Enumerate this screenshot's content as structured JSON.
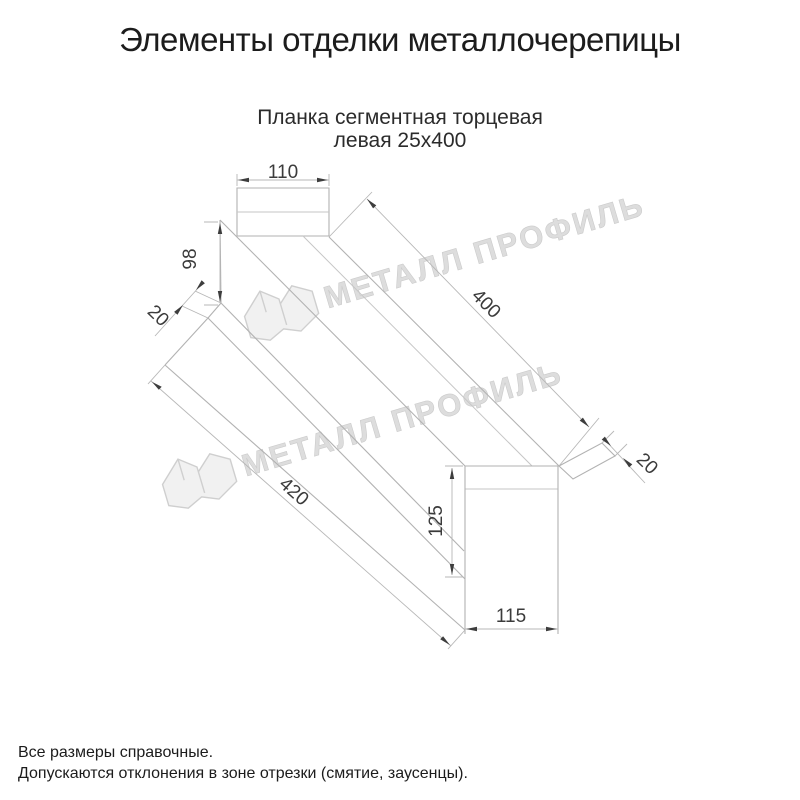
{
  "title": "Элементы отделки металлочерепицы",
  "subtitle": {
    "line1": "Планка сегментная торцевая",
    "line2": "левая 25х400"
  },
  "drawing": {
    "description": "isometric line drawing of left segmental end strip 25x400",
    "line_color": "#b2b2b2",
    "arrow_color": "#3d3d3d",
    "dimensions": {
      "top_width": "110",
      "far_end_height": "98",
      "top_edge_length": "400",
      "bottom_edge_length": "420",
      "near_end_height": "125",
      "near_end_width": "115",
      "left_flange": "20",
      "right_flange": "20"
    },
    "watermark": {
      "text": "МЕТАЛЛ ПРОФИЛЬ",
      "color": "#dddddd"
    }
  },
  "notes": {
    "line1": "Все размеры справочные.",
    "line2": "Допускаются отклонения в зоне отрезки (смятие, заусенцы)."
  }
}
